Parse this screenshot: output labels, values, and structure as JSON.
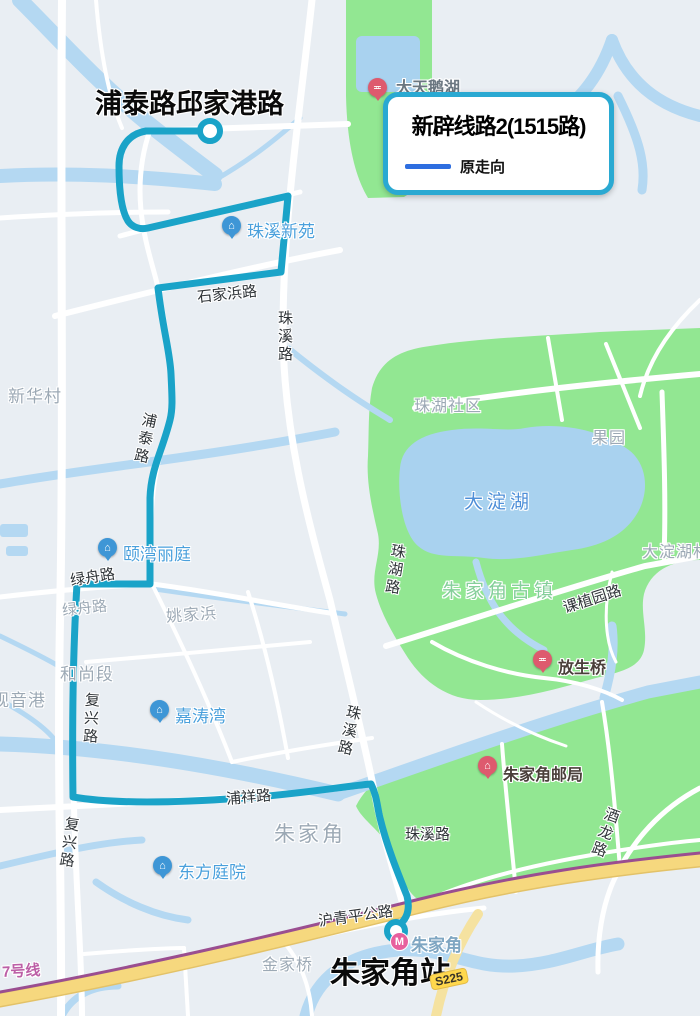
{
  "legend": {
    "title": "新辟线路2(1515路)",
    "items": [
      {
        "label": "原走向",
        "line_color": "#2E6EE0"
      }
    ]
  },
  "annotations": {
    "route_start": "浦泰路邱家港路",
    "route_end": "朱家角站"
  },
  "road_labels": [
    {
      "text": "石家浜路"
    },
    {
      "text": "珠溪路"
    },
    {
      "text": "浦泰路"
    },
    {
      "text": "绿舟路"
    },
    {
      "text": "绿舟路"
    },
    {
      "text": "复兴路"
    },
    {
      "text": "复兴路"
    },
    {
      "text": "浦祥路"
    },
    {
      "text": "珠溪路"
    },
    {
      "text": "珠溪路"
    },
    {
      "text": "珠湖路"
    },
    {
      "text": "课植园路"
    },
    {
      "text": "酒龙路"
    },
    {
      "text": "沪青平公路"
    }
  ],
  "area_labels": [
    {
      "text": "新华村"
    },
    {
      "text": "珠湖社区"
    },
    {
      "text": "果园"
    },
    {
      "text": "大淀湖村"
    },
    {
      "text": "朱家角古镇"
    },
    {
      "text": "姚家浜"
    },
    {
      "text": "和尚段"
    },
    {
      "text": "观音港"
    },
    {
      "text": "朱家角"
    },
    {
      "text": "金家桥"
    }
  ],
  "water_labels": [
    {
      "text": "大淀湖"
    }
  ],
  "pois": [
    {
      "text": "珠溪新苑",
      "type": "blue"
    },
    {
      "text": "颐湾丽庭",
      "type": "blue"
    },
    {
      "text": "嘉涛湾",
      "type": "blue"
    },
    {
      "text": "东方庭院",
      "type": "blue"
    },
    {
      "text": "放生桥",
      "type": "red"
    },
    {
      "text": "朱家角邮局",
      "type": "red"
    },
    {
      "text": "大天鹅湖",
      "type": "red"
    }
  ],
  "transit": {
    "station_name": "朱家角",
    "road_badge": "S225",
    "rail_line_label": "7号线"
  },
  "colors": {
    "route": "#1AA3C8",
    "legend_border": "#2AA9D2",
    "water": "#B4D8F2",
    "green": "#92E792",
    "highway": "#F6D87E",
    "rail": "#9A4E90"
  }
}
